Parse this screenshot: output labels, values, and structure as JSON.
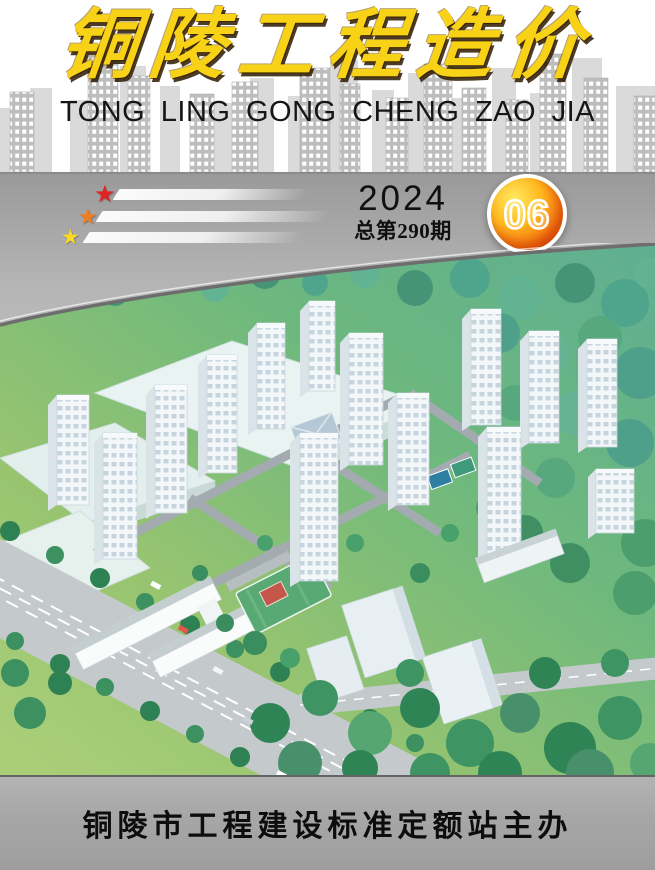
{
  "cover": {
    "title": "铜陵工程造价",
    "title_pinyin": "TONG LING GONG CHENG ZAO JIA",
    "year": "2024",
    "issue_total_label": "总第290期",
    "issue_number": "06",
    "footer_text": "铜陵市工程建设标准定额站主办"
  },
  "decorations": {
    "stars": [
      {
        "name": "red-star",
        "glyph": "★",
        "color": "#e02424"
      },
      {
        "name": "orange-star",
        "glyph": "★",
        "color": "#f07c1e"
      },
      {
        "name": "yellow-star",
        "glyph": "★",
        "color": "#ffd91e"
      }
    ]
  },
  "colors": {
    "title_gold": "#f7d216",
    "pinyin_text": "#161616",
    "skyline_gray": "#bdbdbd",
    "band_gray": "#b4b4b4",
    "badge_orange": "#f46a0f",
    "badge_ring": "#ffffff",
    "footer_gray": "#a7a7a7",
    "footer_text": "#0d0d0d"
  },
  "photo": {
    "alt": "Aerial 3D rendering of a residential compound: white high-rise towers among green and teal trees, warehouses at upper left, a school with sports field, roads with lane markings at lower left, dense woods at right"
  }
}
